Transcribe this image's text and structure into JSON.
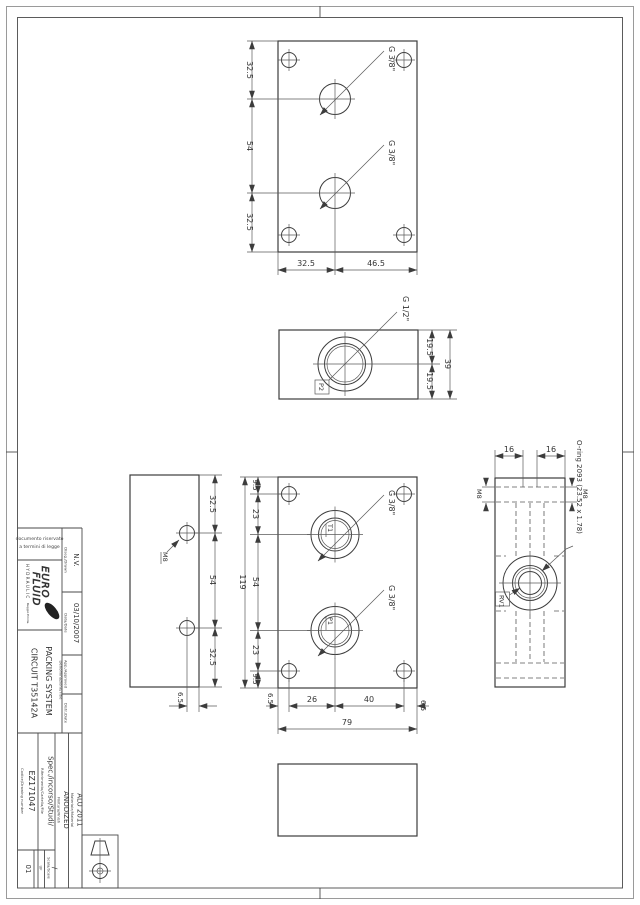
{
  "title_block": {
    "legal": {
      "line1": "documento riservato",
      "line2": "a termini di legge"
    },
    "logo": {
      "name_top": "EURO",
      "name_bottom": "FLUID",
      "subtitle": "HYDRAULIC",
      "tagline": "Reggio Emilia"
    },
    "drawn": {
      "label": "Diseg./Drawn",
      "value": "N.V."
    },
    "date": {
      "label": "Data/Date",
      "value": "03/10/2007"
    },
    "approved": {
      "label": "App./Approved",
      "value": ""
    },
    "distr": {
      "label": "Distr./Date",
      "value": ""
    },
    "denomination": {
      "label": "Denominazione/Title",
      "line1": "PACKING SYSTEM",
      "line2": "CIRCUIT T35142A"
    },
    "material": {
      "label": "Materiale/Material",
      "value": "ALU 2011"
    },
    "finish": {
      "label": "Finitura/Finish",
      "value": "ANODIZED"
    },
    "reference": {
      "label": "Riferimento/Cartella/File",
      "value": "Spec./incorso/Studi/"
    },
    "code": {
      "label": "Codice/Drawing number",
      "value": "EZ171047"
    },
    "scale": {
      "label": "Scala/Scale",
      "value": "/"
    },
    "sheet": {
      "label": "UF",
      "value": "01"
    }
  },
  "views": {
    "top": {
      "port1": "G 3/8\"",
      "port2": "G 3/8\"",
      "dim_left": [
        "32.5",
        "54",
        "32.5"
      ],
      "dim_bottom": [
        "32.5",
        "46.5"
      ]
    },
    "side_p2": {
      "port": "G 1/2\"",
      "tag": "P2",
      "dims": [
        "19.5",
        "19.5",
        "39"
      ]
    },
    "side_m8": {
      "thread": "M8",
      "dim_right": [
        "32.5",
        "54",
        "32.5"
      ],
      "dim_bottom": "6.5"
    },
    "front": {
      "port1": "G 3/8\"",
      "port2": "G 3/8\"",
      "tag1": "T1",
      "tag2": "P1",
      "dim_left": [
        "9.5",
        "23",
        "54",
        "23",
        "9.5"
      ],
      "dim_height": "119",
      "dim_bottom": [
        "6.5",
        "26",
        "40",
        "6.5"
      ],
      "dim_width": "79"
    },
    "side_rv1": {
      "tag": "RV1",
      "oring": "O-ring 2093 (23.52 x 1.78)",
      "dim_top": [
        "16",
        "16"
      ],
      "thread_left": "M8",
      "thread_right": "M8"
    }
  }
}
